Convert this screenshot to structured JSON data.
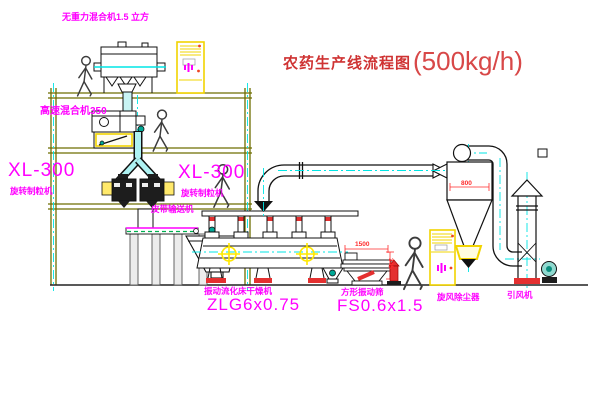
{
  "title": {
    "name": "农药生产线流程图",
    "capacity": "(500kg/h)"
  },
  "labels": {
    "gravity_mixer": "无重力混合机1.5 立方",
    "high_speed_mixer": "高速混合机350",
    "granulator_left_model": "XL-300",
    "granulator_left_name": "旋转制粒机",
    "granulator_right_model": "XL-300",
    "granulator_right_name": "旋转制粒机",
    "belt_conveyor": "皮带输送机",
    "dryer_name": "振动流化床干燥机",
    "dryer_model": "ZLG6x0.75",
    "screen_name": "方形振动筛",
    "screen_model": "FS0.6x1.5",
    "cyclone": "旋风除尘器",
    "fan": "引风机"
  },
  "dimensions": {
    "cyclone_width": "800",
    "screen_length": "1500",
    "screen_height": "345"
  },
  "colors": {
    "label_magenta": "#FF00FF",
    "dimension_red": "#FF2A2A",
    "title_red": "#CF3333",
    "centerline_cyan": "#00E5E5",
    "highlight_yellow": "#FFE800",
    "structure_olive": "#6E6E00",
    "valve_teal": "#00A896",
    "conveyor_green": "#00B050"
  }
}
